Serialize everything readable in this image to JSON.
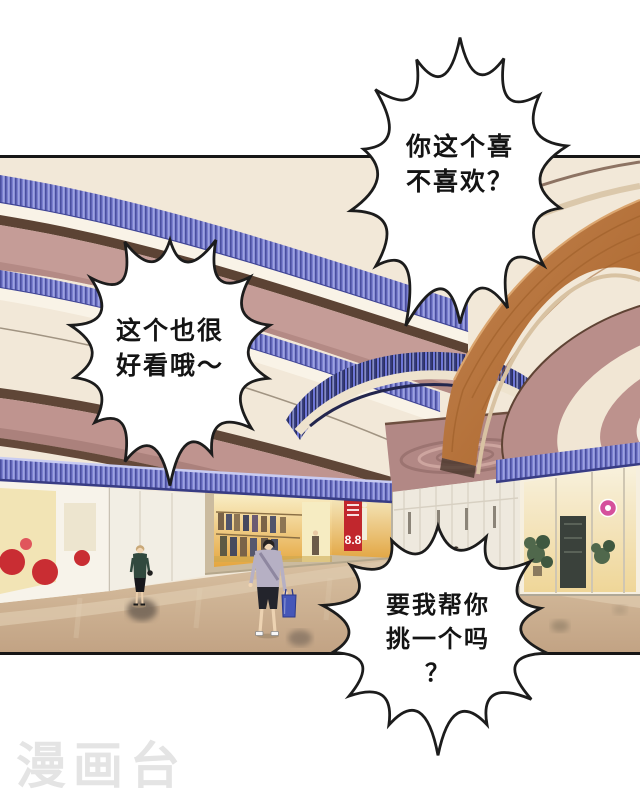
{
  "page": {
    "background_color": "#ffffff"
  },
  "panel": {
    "border_color": "#161616"
  },
  "bubbles": [
    {
      "name": "bubble-top-right",
      "text": "你这个喜\n不喜欢？"
    },
    {
      "name": "bubble-left",
      "text": "这个也很\n好看哦～"
    },
    {
      "name": "bubble-bottom-right",
      "text": "要我帮你\n挑一个吗\n？"
    }
  ],
  "scene": {
    "sale_sign": "8.8",
    "colors": {
      "balcony_pink": "#c59c97",
      "cream": "#f2e8d8",
      "blue_trim": "#7b80d0",
      "glow_blue": "#2b2f5e",
      "escalator_orange": "#b06a33",
      "sale_sign_red": "#c1272d",
      "bag_blue": "#4657b8",
      "floor_tan": "#ccb191"
    }
  },
  "watermark": {
    "text": "漫画台",
    "color": "#e4e4e4"
  }
}
